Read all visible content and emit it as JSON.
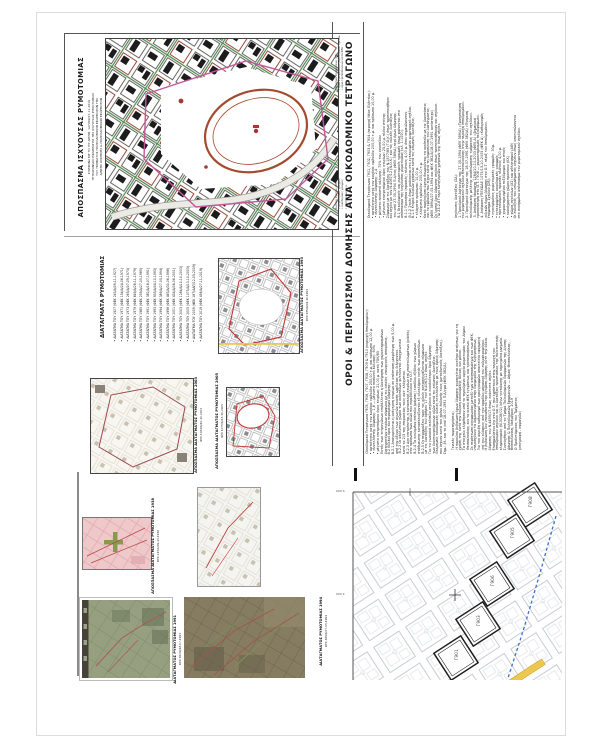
{
  "colors": {
    "green": "#4c8a4c",
    "green2": "#869a50",
    "red": "#c03535",
    "red-brown": "#a34b2f",
    "magenta": "#c4579a",
    "pink": "#efc8ca",
    "yellow": "#ecc84e",
    "blue-dash": "#3f6fd0",
    "sepia": "#867c62",
    "photo-green": "#96a081",
    "grid-grey": "#c3c7ce"
  },
  "sheet": {
    "title_block": {
      "title": "ΑΠΟΣΠΑΣΜΑ ΙΣΧΥΟΥΣΑΣ ΡΥΜΟΤΟΜΙΑΣ",
      "lines": [
        "ΣΥΜΦΩΝΑ ΜΕ ΤΟ ΥΠ' ΑΡΙΘΜ. 127069/27-11-2019",
        "ΤΕΤΡΑΓΩΝΙΔΙΟ ΕΦΑΡΜΟΓΗΣ ΤΗΣ ΙΣΧΥΟΥΣΑΣ ΡΥΜΟΤΟΜΙΑΣ",
        "ΤΟΥ ΤΜΗΜΑΤΟΣ ΠΟΛΕΟΔΟΜΙΚΩΝ ΕΦΑΡΜΟΓΩΝ ΤΗΣ",
        "Δ/ΝΣΗΣ ΔΟΜΗΣΗΣ & ΠΟΛΕΟΔΟΜΙΚΩΝ ΕΦΑΡΜΟΓΩΝ",
        "ΔΗΜΟΥ ΘΕΣΣΑΛΟΝΙΚΗΣ"
      ]
    },
    "diatagmata": {
      "heading": "ΔΙΑΤΑΓΜΑΤΑ ΡΥΜΟΤΟΜΙΑΣ",
      "items": [
        "ΔΙΑΤΑΓΜΑ ΤΟΥ 1927 (ΦΕΚ 243/Α/09-11-1927)",
        "ΔΙΑΤΑΓΜΑ ΤΟΥ 1971 (ΦΕΚ 154/Δ/24-06-1971)",
        "ΔΙΑΤΑΓΜΑ ΤΟΥ 1973 (ΦΕΚ 265/Δ/07-09-1973)",
        "ΔΙΑΤΑΓΜΑ ΤΟΥ 1979 (ΦΕΚ 649/Δ/28-11-1979)",
        "ΔΙΑΤΑΓΜΑ ΤΟΥ 1985 (ΦΕΚ 239/Δ/27-05-1985)",
        "ΔΙΑΤΑΓΜΑ ΤΟΥ 1991 (ΦΕΚ 382/Δ/18-07-1991)",
        "ΔΙΑΤΑΓΜΑ ΤΟΥ 1993 (ΦΕΚ 935/Δ/04-10-1993)",
        "ΔΙΑΤΑΓΜΑ ΤΟΥ 1994 (ΦΕΚ 389/Δ/27-05-1994)",
        "ΔΙΑΤΑΓΜΑ ΤΟΥ 1998 (ΦΕΚ 463/Δ/30-06-1998)",
        "ΔΙΑΤΑΓΜΑ ΤΟΥ 2001 (ΦΕΚ 434/Δ/06-06-2001)",
        "ΔΙΑΤΑΓΜΑ ΤΟΥ 2003 (ΦΕΚ 1284/Δ/10-10-2003)",
        "ΔΙΑΤΑΓΜΑ ΤΟΥ 2005 (ΦΕΚ 1075/Δ/13-10-2005)",
        "ΔΙΑΤΑΓΜΑ ΤΟΥ 2009 (ΦΕΚ 187/ΑΑΠ/12-05-2009)",
        "ΔΙΑΤΑΓΜΑ ΤΟΥ 2019 (ΦΕΚ 456/Δ/27-11-2019)"
      ]
    },
    "extracts": [
      {
        "title": "ΑΠΟΣΠΑΣΜΑ ΔΙΑΤΑΓΜΑΤΟΣ ΡΥΜΟΤΟΜΙΑΣ 1993",
        "fek": "ΦΕΚ 935/Δ/04-10-1993"
      },
      {
        "title": "ΑΠΟΣΠΑΣΜΑ ΔΙΑΤΑΓΜΑΤΟΣ ΡΥΜΟΤΟΜΙΑΣ 2003",
        "fek": "ΦΕΚ 1284/Δ/10-10-2003"
      },
      {
        "title": "ΑΠΟΣΠΑΣΜΑ ΔΙΑΤΑΓΜΑΤΟΣ ΡΥΜΟΤΟΜΙΑΣ 2005",
        "fek": "ΦΕΚ 1075/Δ/13-10-2005"
      },
      {
        "title": "ΑΠΟΣΠΑΣΜΑ ΔΙΑΤΑΓΜΑΤΟΣ ΡΥΜΟΤΟΜΙΑΣ 1938",
        "fek": "ΦΕΚ 243/Α/09-11-1938"
      },
      {
        "title": "ΔΙΑΤΑΓΜΑΤΟΣ ΡΥΜΟΤΟΜΙΑΣ 1991",
        "fek": "ΦΕΚ 382/Δ/18-07-1991"
      },
      {
        "title": "ΔΙΑΤΑΓΜΑΤΟΣ ΡΥΜΟΤΟΜΙΑΣ 1994",
        "fek": "ΦΕΚ 389/Δ/27-05-1994"
      }
    ],
    "oroi": {
      "heading": "ΟΡΟΙ & ΠΕΡΙΟΡΙΣΜΟΙ ΔΟΜΗΣΗΣ ΑΝΑ ΟΙΚΟΔΟΜΙΚΟ ΤΕΤΡΑΓΩΝΟ",
      "note_top": [
        "Υπόμνημα Σημειώσεων (ΣΒ):",
        "• όρια εγκεκριμένου ρυμοτομικού σχεδίου",
        "• όρια τροποποιήσεων κατά ΦΕΚ"
      ],
      "note_mid": [
        "Κωδικοί Σχεδίου (ΣΒ):",
        "• ρυμοτομικές γραμμές",
        "• οικοδομικές γραμμές",
        "• πλάτη οδών σε μ."
      ],
      "blocks": [
        {
          "lines": [
            "Οικοδομικά Τετράγωνα Γ901, Γ902, Γ903 & Γ904 (περιοχή Νέας Ελβετίας):",
            "• αρτιότητα κατά τον κανόνα: εμβαδόν 200,00 τ.μ. και πρόσωπο 10,00 μ.",
            "• συντελεστής δόμησης: 2,4",
            "• μέγιστο ποσοστό κάλυψης: 70% του οικοπέδου",
            "• μέγιστο επιτρεπόμενο ύψος κτιρίων: 25,00 μ. πλέον στέγης",
            "Σύμφωνα με τις διατάξεις του Ν.1577/85 (Γ.Ο.Κ.) όπως τροποποιήθηκε",
            "και ισχύει με τον Ν.4067/12 (Ν.Ο.Κ.) και τις ειδικές διατάξεις",
            "του από 27-05-1994 Π.Δ/τος (ΦΕΚ 389/Δ) περί όρων δόμησης.",
            "Β.1 Οικοδομικές και ρυμοτομικές γραμμές όπως φαίνονται στο",
            "απόσπασμα της ισχύουσας ρυμοτομίας (κλ. 1:1000).",
            "Β.1.1 Προκήπια (πρασιές) πλάτους 4,00 μ. όπου σημειώνονται.",
            "Β.1.2 Στοές όπως φαίνονται στο εγκεκριμένο ρυμοτομικό σχέδιο.",
            "Β.1.3 Κτίρια ειδικών χρήσεων κατά τις κείμενες διατάξεις.",
            "• ελάχιστο πρόσωπο: 10,00 μ.",
            "• ελάχιστο εμβαδόν: 200,00 τ.μ.",
            "Κατά παρέκκλιση άρτια θεωρούνται τα οικόπεδα με τις διαστάσεις",
            "και το εμβαδόν που είχαν κατά τη δημοσίευση του διατάγματος.",
            "(ΦΕΚ 389/Δ/27-05-1994 και ΦΕΚ 382/Δ/18-07-1991 αντίστοιχα)",
            "Οι λοιποί όροι δόμησης ισχύουν όπως τροποποιήθηκαν και ισχύουν.",
            "ΠΔ 23-2-87 περί κατηγοριών χρήσεων γης όπως ισχύει."
          ]
        },
        {
          "lines": [
            "Οικοδομικά Τετράγωνα Γ905, Γ906, Γ907, Γ908, Γ909 & Γ910 (περιοχή Ιπποδρομίου):",
            "• αρτιότητα κατά τον κανόνα: εμβαδόν 250,00 τ.μ. και πρόσωπο 12,00 μ.",
            "• συντελεστής δόμησης: 1,8 — μέγιστο ποσοστό κάλυψης: 60%",
            "• μέγιστο επιτρεπόμενο ύψος κτιρίων: 21,00 μ. κατά ΓΟΚ/85",
            "Εντός των τετραγώνων επιβάλλεται η διατήρηση των χαρακτηρισμένων",
            "διατηρητέων κτιρίων σύμφωνα με τις οικείες υπουργικές αποφάσεις.",
            "Β.2 Ειδικοί όροι και περιορισμοί δόμησης:",
            "Β.2.1 Απαγορεύεται η ανέγερση κτιρίων σε απόσταση μικρότερη των 5,00 μ.",
            "από τον άξονα των αγωγών κοινής ωφέλειας που διέρχονται.",
            "Β.2.2 Οι ακάλυπτοι χώροι των οικοπέδων φυτεύονται υποχρεωτικά",
            "κατά τα 2/3 της επιφανείας τους κατ' ελάχιστον.",
            "Β.2.3 Δεν επιτρέπεται η κατασκευή κτιρίων επί υποστυλωμάτων (pilotis)",
            "στα πρόσωπα των οδών που περιβάλλουν το Ο.Τ.",
            "Β.2.4 Τα κεκλιμένα επίπεδα (ράμπες) εισόδου-εξόδου των χώρων",
            "στάθμευσης κατασκευάζονται εξ ολοκλήρου εντός των οικοπέδων.",
            "Β.2.5 Οι περιφράξεις προς τις οδούς κατασκευάζονται σύμφωνα",
            "με τις διατάξεις του άρθρου 17 του Ν.4067/12 όπως ισχύει.",
            "Για τα γωνιακά οικόπεδα ισχύουν οι ευνοϊκότεροι όροι δόμησης",
            "των διασταυρούμενων οδών κατά τις κείμενες διατάξεις.",
            "Εκκρεμείς οικοδομικές άδειες εκτελούνται με τους όρους δόμησης",
            "που ίσχυαν κατά τον χρόνο έκδοσής τους (μεταβατικές διατάξεις).",
            "Σημ.: βλ. και το από 18-07-1991 Π.Δ/γμα (ΦΕΚ 382/Δ)."
          ]
        },
        {
          "lines": [
            "Ισχύουσες διατάξεις (ΣΔ):",
            "1. Προεδρικό Διάταγμα της 27-05-1994 (ΦΕΚ 389/Δ) «Τροποποίηση",
            "του ρυμοτομικού σχεδίου Θεσσαλονίκης στην περιοχή Ιπποδρομίου».",
            "2. Προεδρικό Διάταγμα της 18-07-1991 (ΦΕΚ 382/Δ) «Έγκριση",
            "πολεοδομικής μελέτης αναθεώρησης τμήματος του σχεδίου».",
            "3. Απόφαση Νομάρχη 1284/10-10-2003 (ΦΕΚ Δ) «Σημειακή",
            "τροποποίηση στο Ο.Τ. Γ906 — χαρακτηρισμός πεζοδρόμων».",
            "4. Απόφαση ΥΠΕΧΩΔΕ 1075/13-10-2005 (ΦΕΚ Δ) «Καθορισμός",
            "ειδικών όρων δόμησης στα Ο.Τ. πέριξ του Ιπποδρομίου».",
            "Υπόμνημα Σχεδίου (ΣΒ):",
            "• εγκεκριμένες ρυμοτομικές γραμμές: 30μ.",
            "• εγκεκριμένες οικοδομικές γραμμές",
            "• προτεινόμενες πρασιές πλάτους 4,00 μ.",
            "• χαρακτηρισμένοι πεζόδρομοι και στοές",
            "• κοινόχρηστοι χώροι πρασίνου (ΚΧ)",
            "• χώροι σχολείων (ΧΣ) και αθλητισμού (ΑΘ)",
            "Οι ενδείξεις του υπομνήματος ισχύουν όπως αποτυπώνονται",
            "στο συνημμένο απόσπασμα του ρυμοτομικού σχεδίου."
          ]
        },
        {
          "lines": [
            "Γενικές παρατηρήσεις:",
            "Η παρούσα βεβαίωση όρων δόμησης χορηγείται κατόπιν αιτήσεως για τη",
            "χρήση της κατά την έκδοση οικοδομικής άδειας και μόνον.",
            "Τα στοιχεία ελήφθησαν από το τηρούμενο αρχείο ρυμοτομίας του Δήμου",
            "Θεσσαλονίκης και τα οικεία ΦΕΚ εγκρίσεως και τροποποιήσεων.",
            "Σε περίπτωση ασυμφωνίας μεταξύ των αποσπασμάτων και των ΦΕΚ,",
            "υπερισχύουν τα δημοσιευμένα στην Εφημερίδα της Κυβερνήσεως.",
            "Για τον ακριβή καθορισμό των οριογραμμών απαιτείται εφαρμογή",
            "επί του εδάφους από τον αρμόδιο μηχανικό του ενδιαφερομένου.",
            "Η βεβαίωση δεν υποκαθιστά την έγκριση δόμησης ούτε την άδεια",
            "δόμησης του Ν.4495/17 όπως εκάστοτε ισχύει.",
            "Επισημαίνεται ότι στα Ο.Τ. που εμπίπτουν στην περιοχή του",
            "Ιπποδρομίου ισχύουν και οι διατάξεις προστασίας της πολιτιστικής",
            "κληρονομιάς (Ν.3028/02) λόγω γειτνίασης με κηρυγμένα μνημεία.",
            "Συντάχθηκε από το Τμήμα Πολεοδομικών Εφαρμογών της Δ/νσης",
            "Δόμησης & Πολεοδομικών Εφαρμογών — Δήμος Θεσσαλονίκης.",
            "Θεσσαλονίκη, Νοέμβριος 2019",
            "Ο Προϊστάμενος του Τμήματος",
            "(υπογραφή - σφραγίδα)"
          ]
        }
      ]
    },
    "bottom_map": {
      "labels": [
        "Γ908",
        "Γ905",
        "Γ906",
        "Γ903",
        "Γ901"
      ],
      "grid_labels": [
        "5.000",
        "2.000"
      ]
    }
  }
}
